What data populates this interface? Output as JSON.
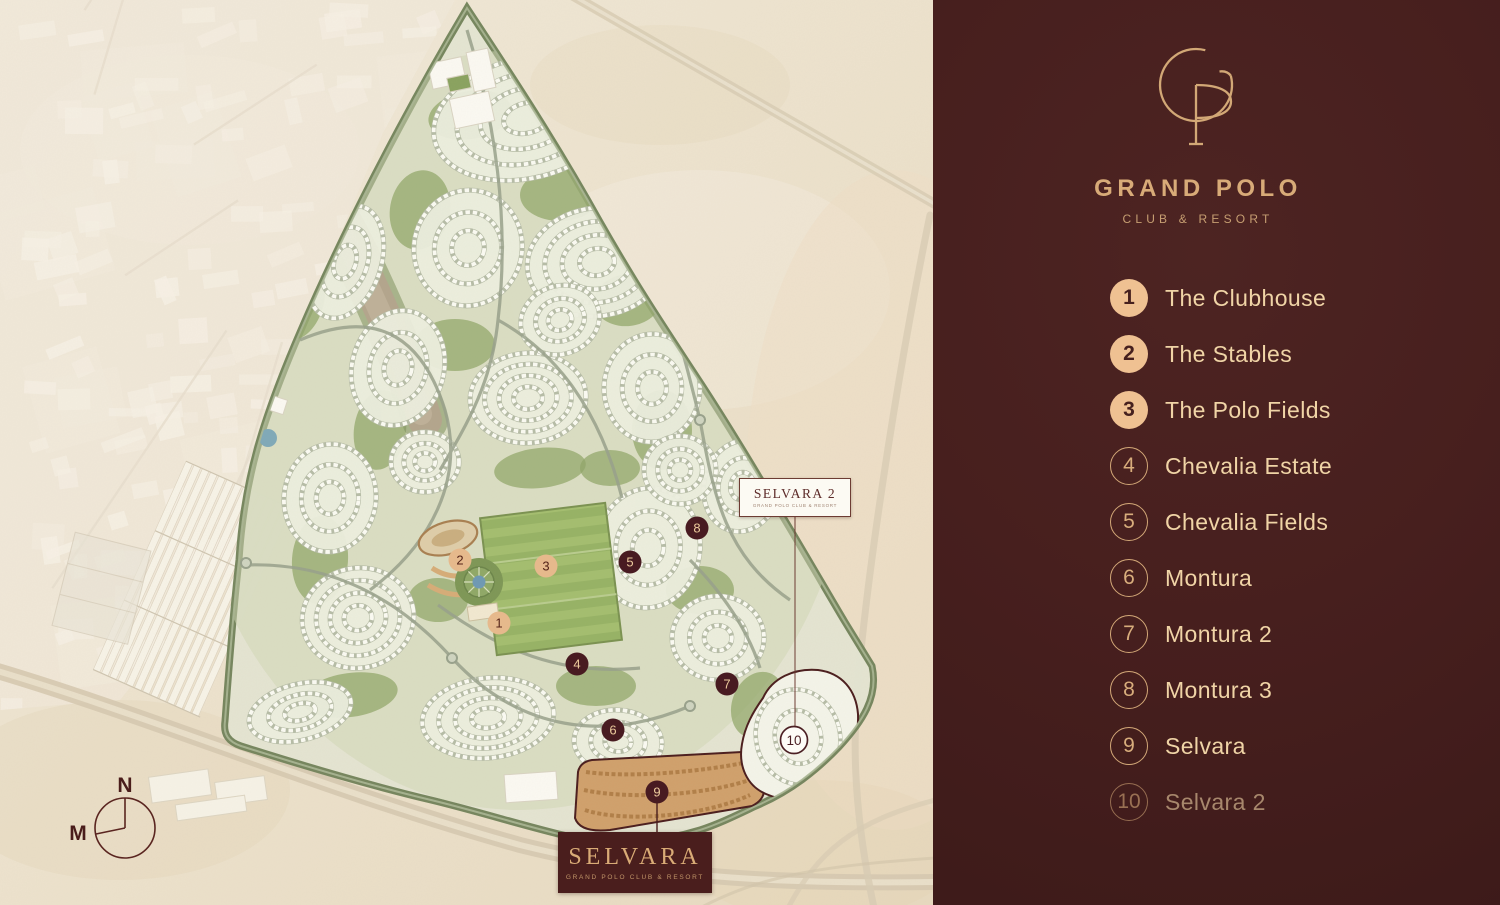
{
  "brand": {
    "monogram": "GP",
    "name": "GRAND POLO",
    "subtitle": "CLUB & RESORT"
  },
  "colors": {
    "sidebar_bg": "#461f1e",
    "gold": "#d8ab78",
    "gold_light": "#f0d4a6",
    "legend_filled_circle": "#efc192",
    "marker_dark": "#481b21",
    "marker_tan": "#e6b98c",
    "marker_light": "#fdfcf7",
    "desert": "#ece1cb"
  },
  "legend": {
    "items": [
      {
        "num": "1",
        "label": "The Clubhouse",
        "style": "filled",
        "dimmed": false
      },
      {
        "num": "2",
        "label": "The Stables",
        "style": "filled",
        "dimmed": false
      },
      {
        "num": "3",
        "label": "The Polo Fields",
        "style": "filled",
        "dimmed": false
      },
      {
        "num": "4",
        "label": "Chevalia Estate",
        "style": "outline",
        "dimmed": false
      },
      {
        "num": "5",
        "label": "Chevalia Fields",
        "style": "outline",
        "dimmed": false
      },
      {
        "num": "6",
        "label": "Montura",
        "style": "outline",
        "dimmed": false
      },
      {
        "num": "7",
        "label": "Montura 2",
        "style": "outline",
        "dimmed": false
      },
      {
        "num": "8",
        "label": "Montura 3",
        "style": "outline",
        "dimmed": false
      },
      {
        "num": "9",
        "label": "Selvara",
        "style": "outline",
        "dimmed": false
      },
      {
        "num": "10",
        "label": "Selvara 2",
        "style": "outline",
        "dimmed": true
      }
    ]
  },
  "map": {
    "markers": [
      {
        "num": "1",
        "x": 499,
        "y": 623,
        "style": "tan"
      },
      {
        "num": "2",
        "x": 460,
        "y": 560,
        "style": "tan"
      },
      {
        "num": "3",
        "x": 546,
        "y": 566,
        "style": "tan"
      },
      {
        "num": "4",
        "x": 577,
        "y": 664,
        "style": "dark"
      },
      {
        "num": "5",
        "x": 630,
        "y": 562,
        "style": "dark"
      },
      {
        "num": "6",
        "x": 613,
        "y": 730,
        "style": "dark"
      },
      {
        "num": "7",
        "x": 727,
        "y": 684,
        "style": "dark"
      },
      {
        "num": "8",
        "x": 697,
        "y": 528,
        "style": "dark"
      },
      {
        "num": "9",
        "x": 657,
        "y": 792,
        "style": "dark"
      },
      {
        "num": "10",
        "x": 794,
        "y": 740,
        "style": "light"
      }
    ],
    "selvara_label": {
      "title": "SELVARA",
      "subtitle": "GRAND POLO CLUB & RESORT"
    },
    "selvara2_label": {
      "title": "SELVARA 2",
      "subtitle": "GRAND POLO CLUB & RESORT"
    },
    "compass": {
      "north": "N",
      "makkah": "M"
    }
  }
}
